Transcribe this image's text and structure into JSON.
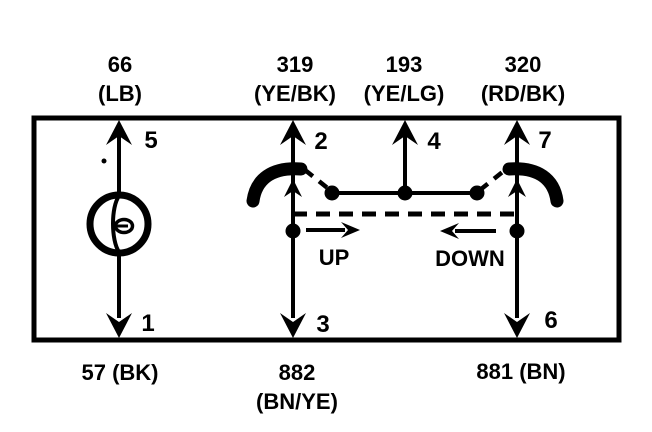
{
  "colors": {
    "ink": "#000000",
    "paper": "#ffffff"
  },
  "terminals": {
    "top": [
      {
        "circuit": "66",
        "code": "(LB)",
        "pin": "5"
      },
      {
        "circuit": "319",
        "code": "(YE/BK)",
        "pin": "2"
      },
      {
        "circuit": "193",
        "code": "(YE/LG)",
        "pin": "4"
      },
      {
        "circuit": "320",
        "code": "(RD/BK)",
        "pin": "7"
      }
    ],
    "bottom": [
      {
        "circuit": "57 (BK)",
        "pin": "1"
      },
      {
        "circuit": "882",
        "code": "(BN/YE)",
        "pin": "3"
      },
      {
        "circuit": "881 (BN)",
        "pin": "6"
      }
    ]
  },
  "actions": {
    "up": "UP",
    "down": "DOWN"
  }
}
